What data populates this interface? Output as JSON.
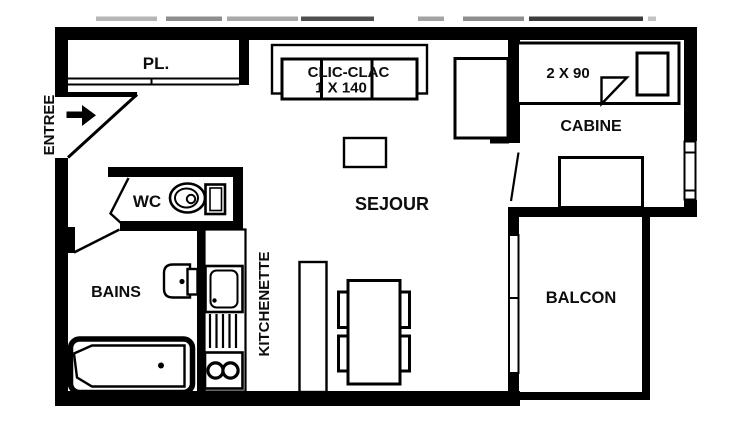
{
  "floorplan": {
    "rooms": {
      "entree": "ENTREE",
      "placard": "PL.",
      "wc": "WC",
      "bains": "BAINS",
      "kitchenette": "KITCHENETTE",
      "sejour": "SEJOUR",
      "cabine": "CABINE",
      "balcon": "BALCON"
    },
    "furniture": {
      "sofa_label_line1": "CLIC-CLAC",
      "sofa_label_line2": "1 X 140",
      "cabine_bed_label": "2 X 90"
    },
    "colors": {
      "wall": "#000000",
      "background": "#ffffff",
      "text": "#0d0d0d"
    }
  }
}
